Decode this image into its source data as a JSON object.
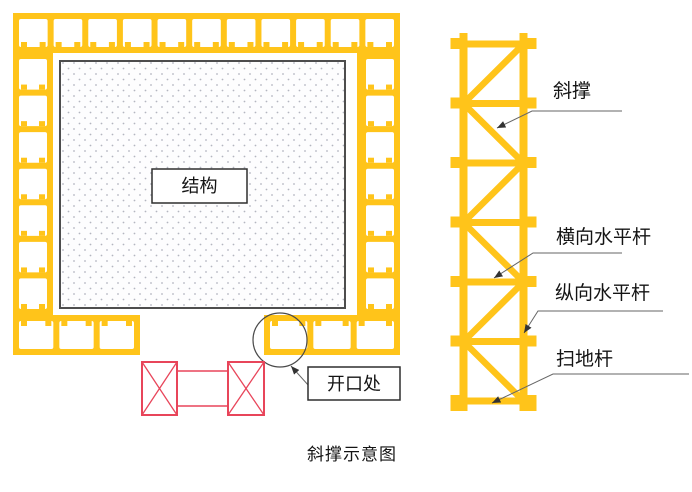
{
  "caption": "斜撑示意图",
  "plan_view": {
    "structure_label": "结构",
    "opening_label": "开口处"
  },
  "elevation_view": {
    "labels": [
      {
        "text": "斜撑"
      },
      {
        "text": "横向水平杆"
      },
      {
        "text": "纵向水平杆"
      },
      {
        "text": "扫地杆"
      }
    ]
  },
  "colors": {
    "scaffold_yellow": "#FFC41A",
    "opening_red": "#E8455A",
    "leader_gray": "#666666",
    "structure_border": "#4D4D4D",
    "dot_gray": "#B3B6C0"
  }
}
